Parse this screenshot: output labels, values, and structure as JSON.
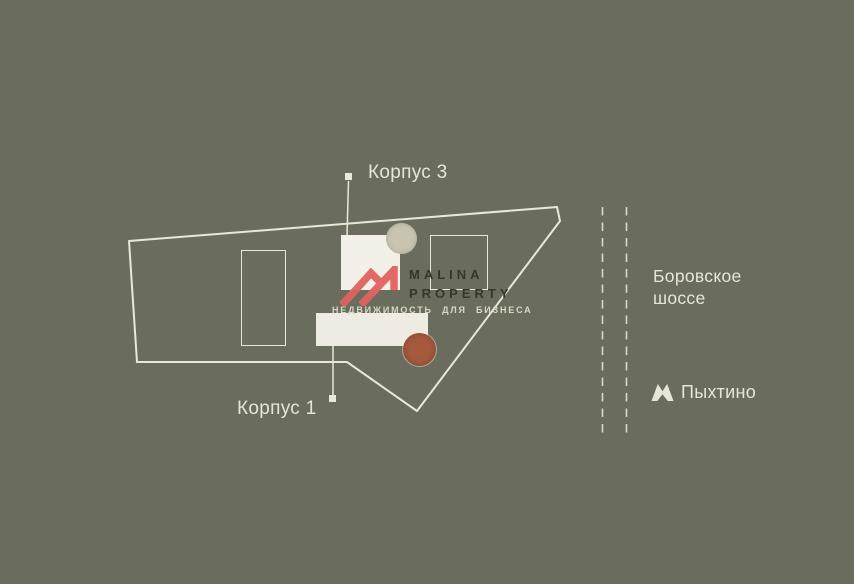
{
  "canvas": {
    "width": 854,
    "height": 584
  },
  "site_plan": {
    "building3_label": "Корпус 3",
    "building1_label": "Корпус 1"
  },
  "road": {
    "name_line1": "Боровское",
    "name_line2": "шоссе"
  },
  "metro": {
    "station_name": "Пыхтино",
    "logo_icon": "moscow-metro-m"
  },
  "watermark": {
    "brand_line1": "MALINA",
    "brand_line2": "PROPERTY",
    "tagline": "НЕДВИЖИМОСТЬ ДЛЯ БИЗНЕСА"
  },
  "colors": {
    "background": "#6a6d5d",
    "outline": "#e9e7db",
    "label_text": "#e7e5d8",
    "road_dash": "#d9d8c9",
    "building_fill": "#f2f0e9",
    "building_fill_warm": "#eeebe2",
    "circle_beige": "#cac5b2",
    "circle_terracotta": "#a55a3e",
    "watermark_red": "#e16361",
    "watermark_dark": "#35372c",
    "watermark_tagline": "#d8d6c6"
  }
}
